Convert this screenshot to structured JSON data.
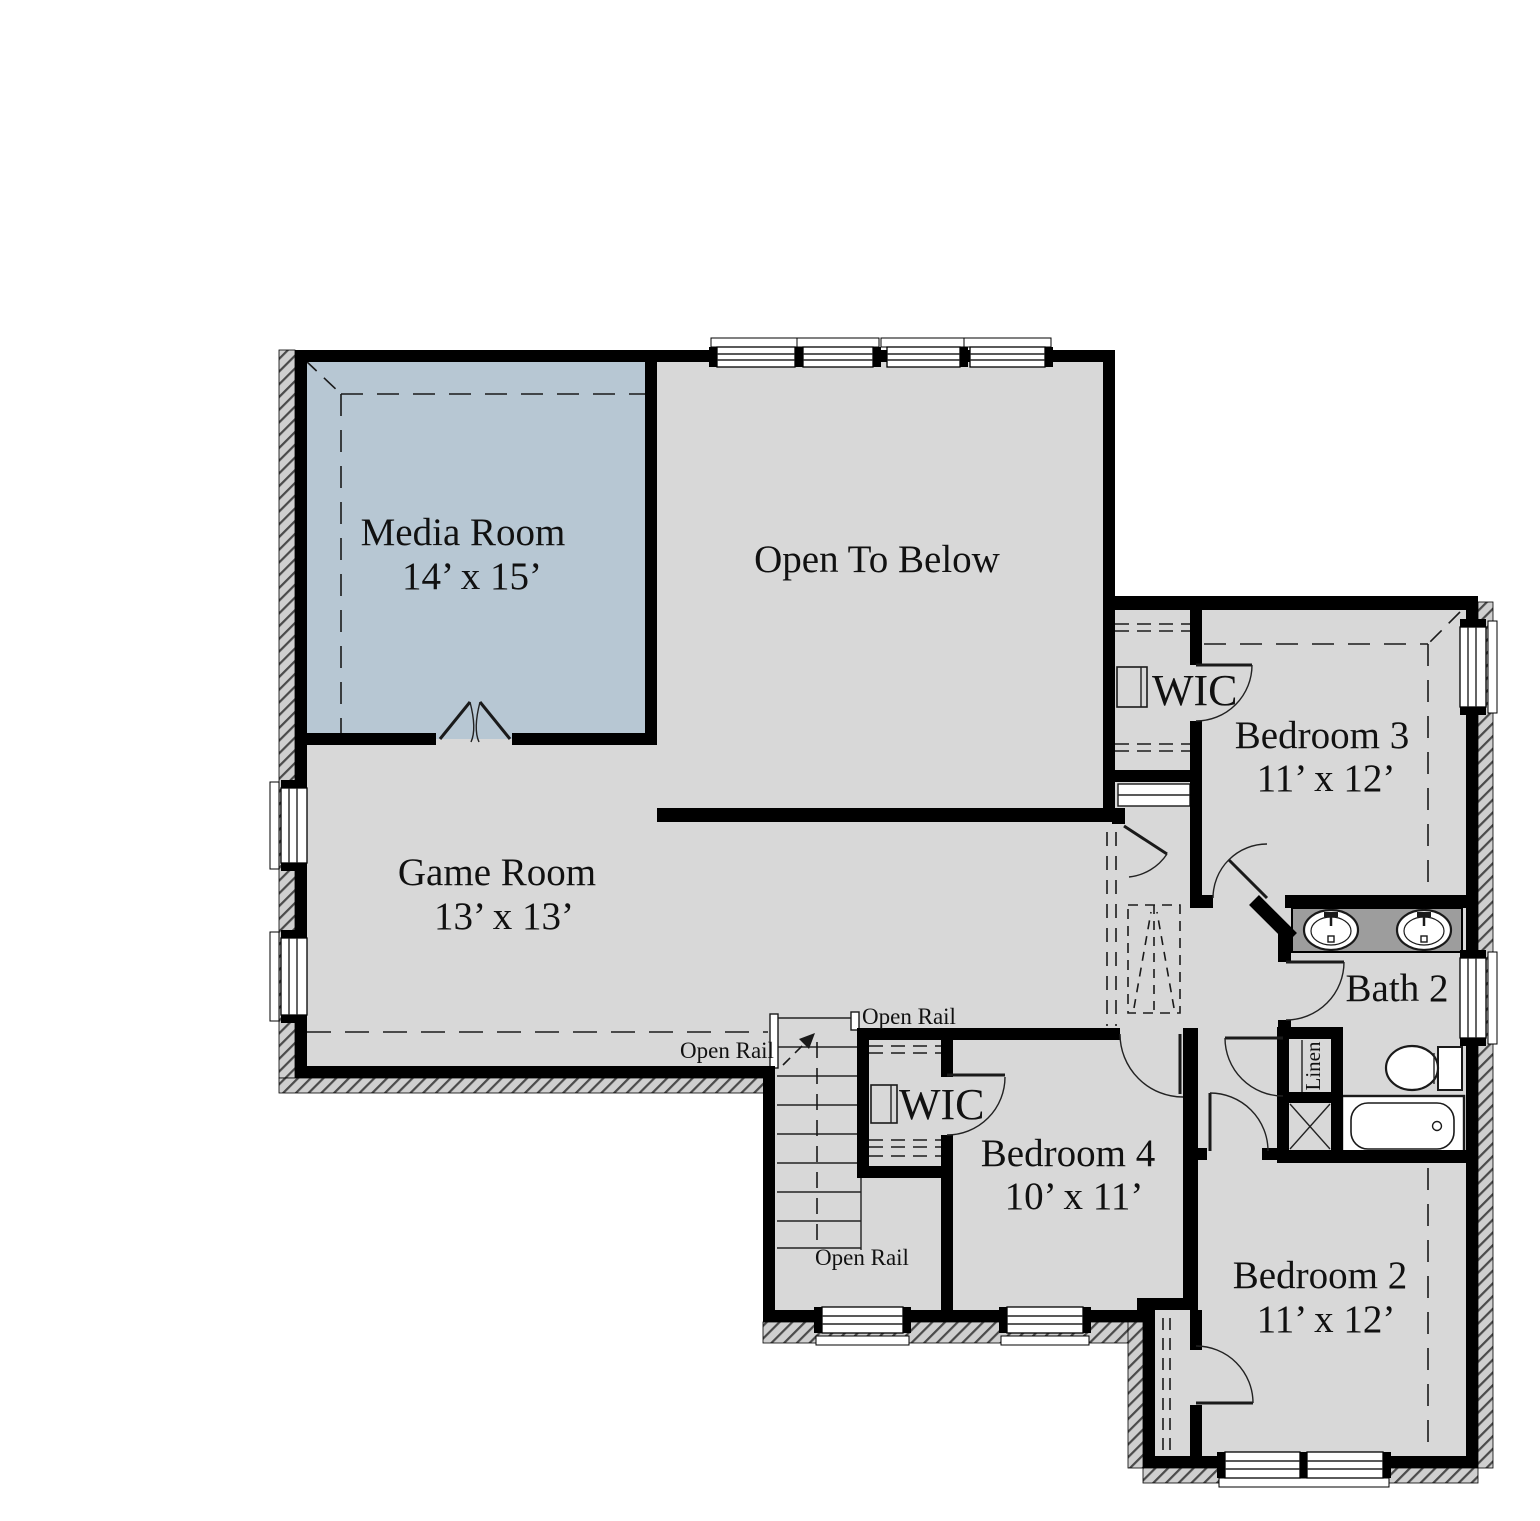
{
  "plan": {
    "rooms": {
      "media": {
        "name": "Media Room",
        "dims": "14’ x 15’"
      },
      "open_to_below": {
        "name": "Open To Below"
      },
      "game": {
        "name": "Game Room",
        "dims": "13’ x 13’"
      },
      "wic_bed3": {
        "name": "WIC"
      },
      "bed3": {
        "name": "Bedroom 3",
        "dims": "11’ x 12’"
      },
      "bath2": {
        "name": "Bath 2"
      },
      "linen": {
        "name": "Linen"
      },
      "wic_bed4": {
        "name": "WIC"
      },
      "bed4": {
        "name": "Bedroom 4",
        "dims": "10’ x 11’"
      },
      "bed2": {
        "name": "Bedroom 2",
        "dims": "11’ x 12’"
      }
    },
    "annotations": {
      "open_rail": "Open Rail"
    },
    "colors": {
      "room_fill": "#d8d8d8",
      "media_fill": "#b7c7d3",
      "wall": "#000000",
      "vanity_fill": "#9d9d9d",
      "hatch_bg": "#cfcfcf"
    }
  }
}
